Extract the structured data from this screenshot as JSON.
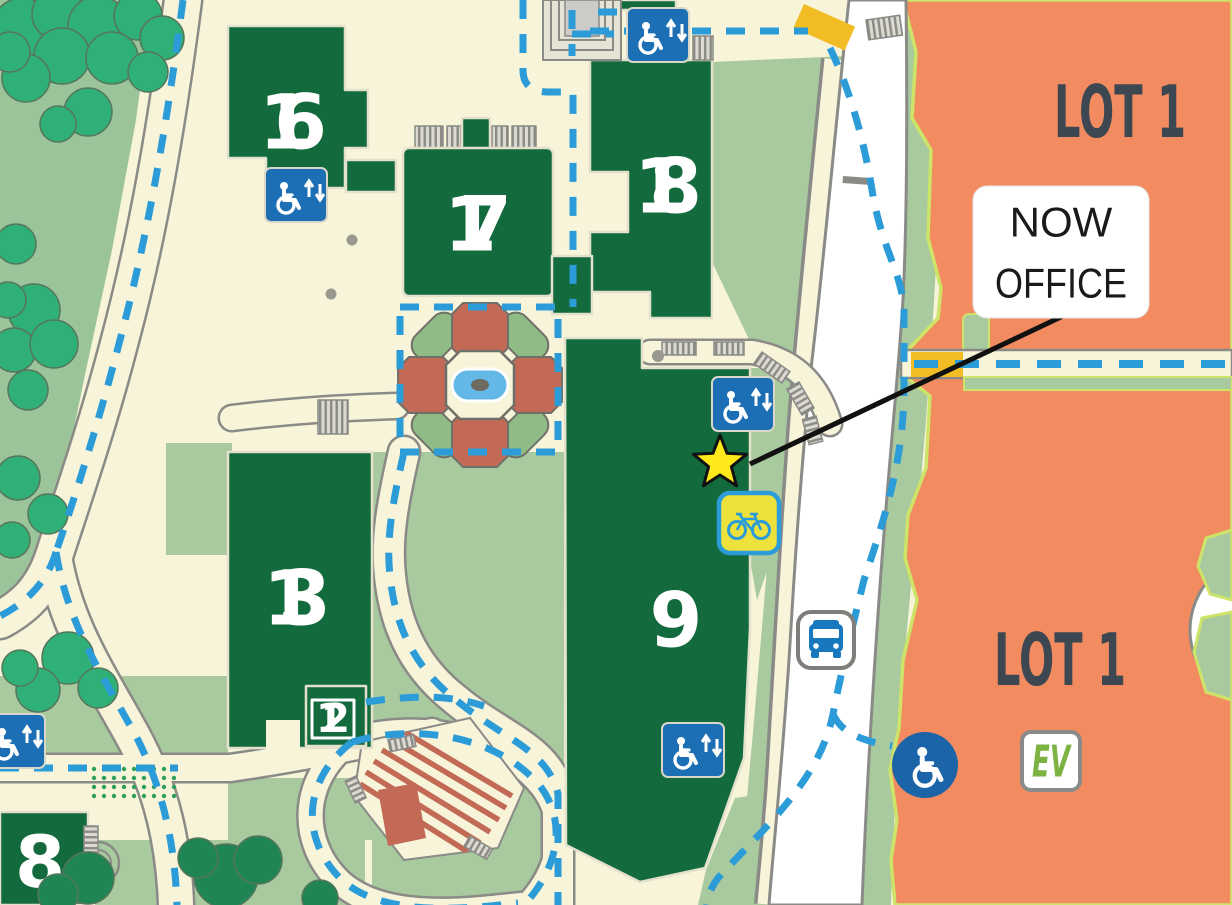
{
  "labels": {
    "buildings": {
      "b16": "16",
      "b17": "17",
      "b18": "18",
      "b13": "13",
      "b12": "12",
      "b9": "9",
      "b8": "8"
    },
    "lot1_top": "LOT 1",
    "lot1_bottom": "LOT 1",
    "callout": {
      "line1": "NOW",
      "line2": "OFFICE"
    },
    "ev": "EV"
  },
  "markers": {
    "star": "office-location-star",
    "accessible_entrances": 5,
    "accessible_parking": "wheelchair-circle",
    "bus_stop": "bus-sign",
    "bike_parking": "bike-sign",
    "ev_charging": "ev-sign"
  },
  "colors": {
    "path_cream": "#F7F4DA",
    "campus_grass": "#A8CA9E",
    "park_grass": "#9CC49B",
    "tree_green": "#2FB077",
    "building_green": "#136B3D",
    "road_white": "#FFFFFF",
    "road_edge": "#8A8A86",
    "bike_blue": "#2B9CD8",
    "lot_orange": "#F28C60",
    "lot_edge_lime": "#CDE469",
    "crosswalk_yellow": "#F2BD24",
    "star_yellow": "#FFE81A",
    "sign_blue": "#1C6FB4",
    "parking_circle_blue": "#1B64A8",
    "bus_blue": "#1778BE",
    "ev_green": "#7CB342",
    "lot_text": "#3D4752",
    "planter_terracotta": "#C26A56",
    "fountain_blue": "#63B8E8"
  }
}
